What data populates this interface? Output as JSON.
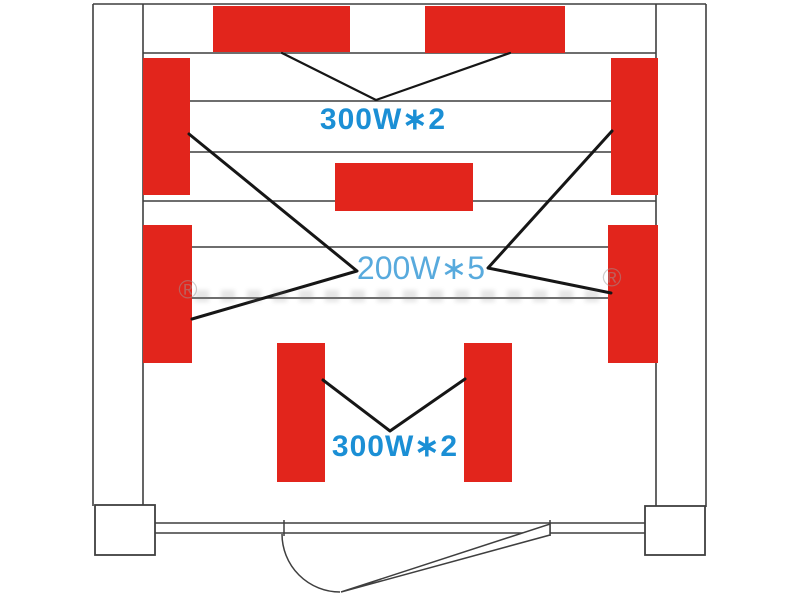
{
  "labels": {
    "top_heaters": "300W∗2",
    "side_heaters": "200W∗5",
    "bench_heaters": "300W∗2"
  },
  "watermark": {
    "symbol": "®"
  },
  "colors": {
    "panel-red": "#e2251c",
    "label-blue-bold": "#1b8fd5",
    "label-blue-light": "#58aadd",
    "wall-gray": "#3f3f3f",
    "leader-black": "#161616"
  },
  "panel_groups": [
    {
      "group": "top-wall-heaters",
      "count": 2,
      "label": "300W∗2"
    },
    {
      "group": "side-and-center-heaters",
      "count": 5,
      "label": "200W∗5"
    },
    {
      "group": "bench-heaters",
      "count": 2,
      "label": "300W∗2"
    }
  ]
}
